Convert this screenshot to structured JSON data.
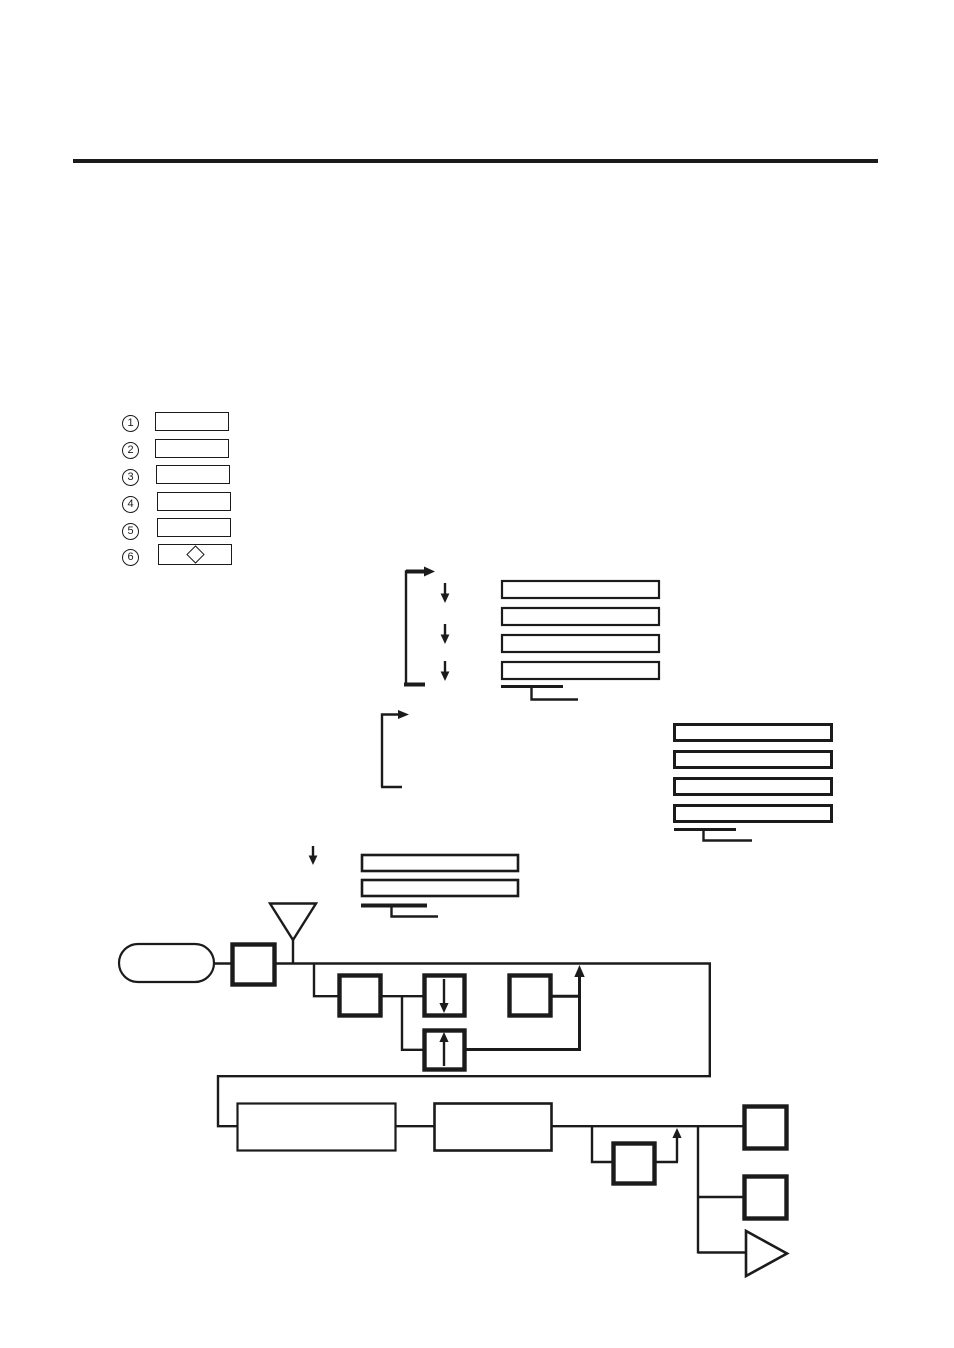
{
  "colors": {
    "ink": "#1b1b1b",
    "paper": "#ffffff"
  },
  "header": {
    "rule": "section-divider"
  },
  "legend": {
    "items": [
      {
        "label": "1",
        "box": "blank"
      },
      {
        "label": "2",
        "box": "blank"
      },
      {
        "label": "3",
        "box": "blank"
      },
      {
        "label": "4",
        "box": "blank"
      },
      {
        "label": "5",
        "box": "blank"
      },
      {
        "label": "6",
        "box": "diamond-symbol"
      }
    ]
  },
  "diagram": {
    "upper_sequence": {
      "loop_bracket": "repeat-loop-arrow",
      "down_arrows": 3,
      "blank_boxes": 4,
      "continuation": "step-connector"
    },
    "right_sequence": {
      "blank_boxes": 4,
      "continuation": "step-connector"
    },
    "middle_sequence": {
      "entry_arrow": "down-arrow",
      "blank_boxes": 2,
      "continuation": "step-connector"
    },
    "block_flow": {
      "antenna": "antenna-symbol",
      "source": "capsule-blank",
      "blocks": {
        "bold_small": 7,
        "down_arrow_block": 1,
        "up_arrow_block": 1,
        "wide_blank": 2
      },
      "output": "triangle-symbol",
      "feedback_arrows_up": 2
    }
  }
}
